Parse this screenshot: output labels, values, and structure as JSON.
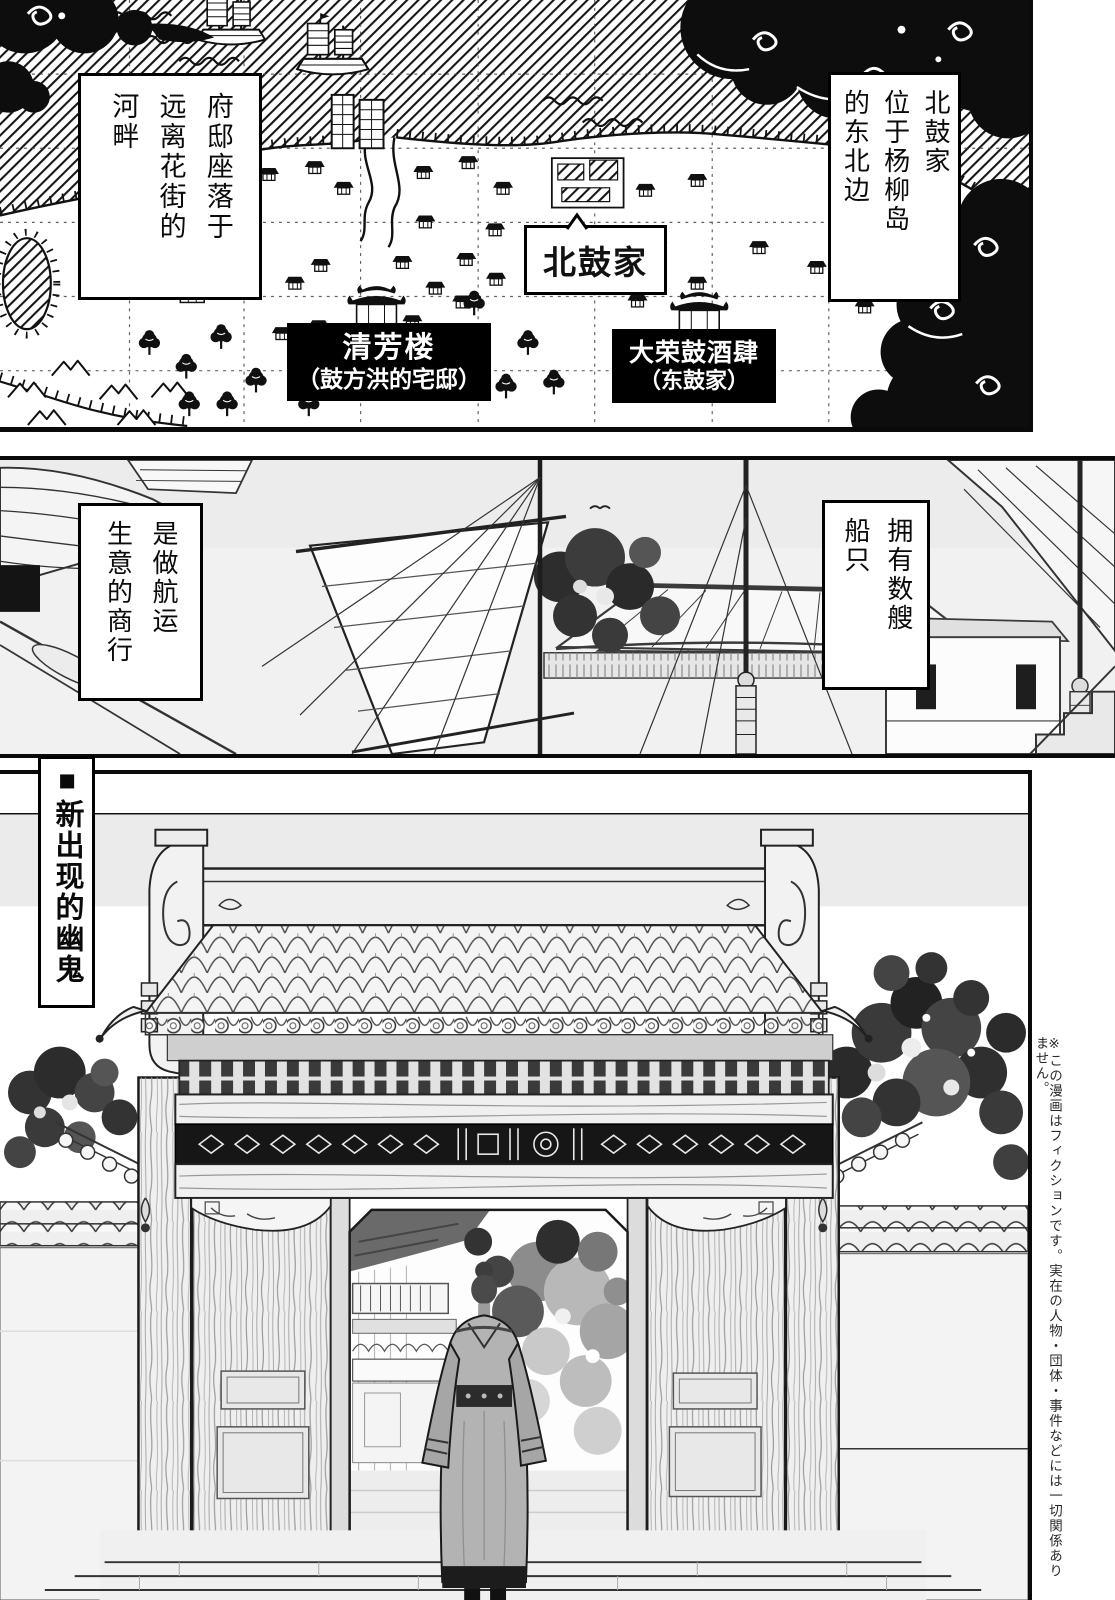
{
  "page": {
    "width": 1115,
    "height": 1600,
    "background": "#ffffff",
    "ink": "#111111"
  },
  "panel_map": {
    "speech_residence": "府邸座落于\n远离花街的\n河畔",
    "speech_location": "北鼓家\n位于杨柳岛\n的东北边",
    "label_north_drum": "北鼓家",
    "label_qingfang": {
      "line1": "清芳楼",
      "line2": "（鼓方洪的宅邸）"
    },
    "label_darong": {
      "line1": "大荣鼓酒肆",
      "line2": "（东鼓家）"
    }
  },
  "panel_harbor": {
    "speech_ships": "拥有数艘\n船只",
    "speech_business": "是做航运\n生意的商行"
  },
  "panel_gate": {
    "side_title": "■新出现的幽鬼",
    "disclaimer": "※この漫画はフィクションです。実在の人物・団体・事件などには一切関係ありません。"
  }
}
